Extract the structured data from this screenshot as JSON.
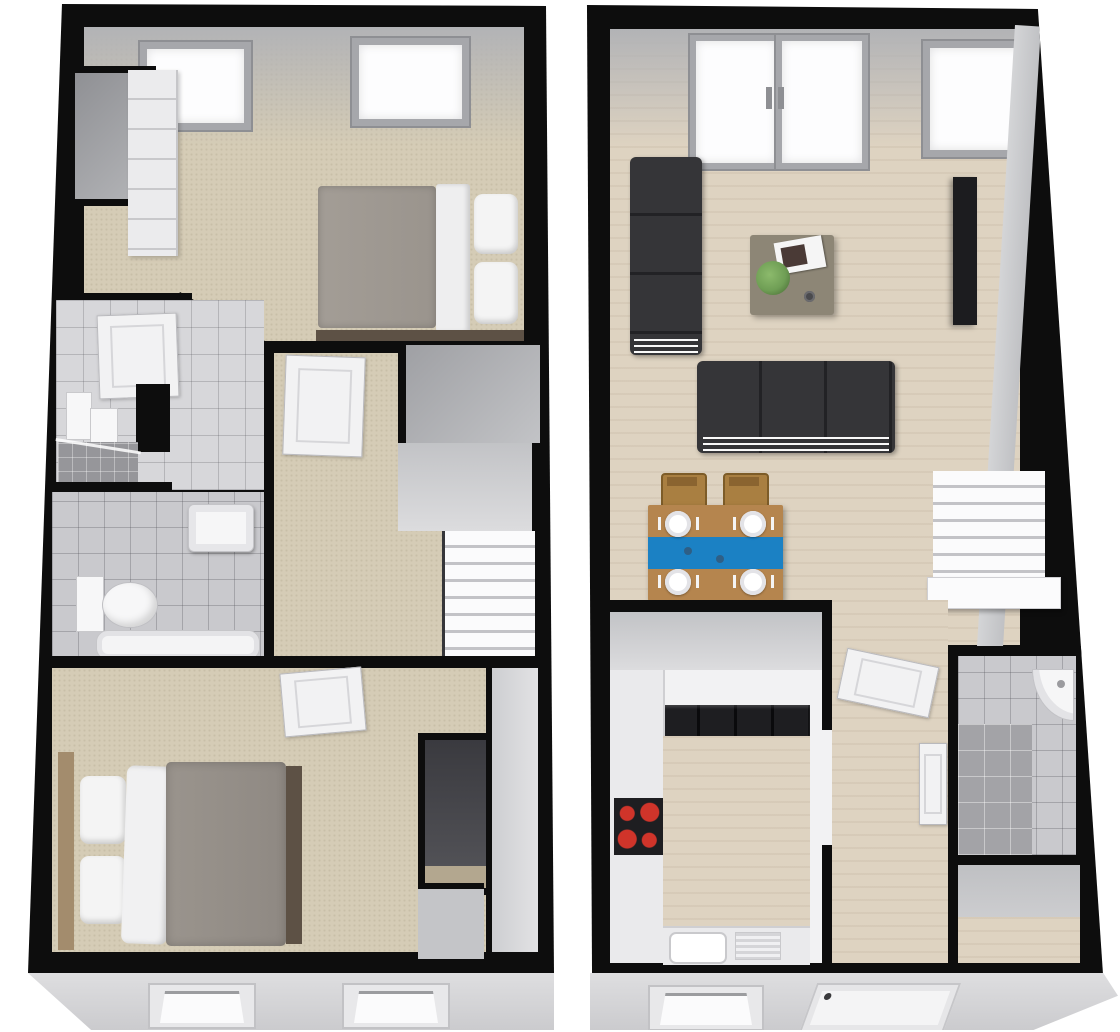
{
  "meta": {
    "type": "3d-dollhouse-floorplan",
    "floor_count": 2,
    "page_background": "#ffffff"
  },
  "colors": {
    "wall": "#0d0d0d",
    "carpet": "#d5ccb6",
    "wood": "#ded3c1",
    "tile_light": "#d7d7da",
    "tile_mid": "#c9c9cd",
    "tile_wet": "#a3a3a7",
    "wall_white": "#f2f2f3",
    "wall_grey": "#c7c8ca",
    "ceiling_grey": "#b2b3b6",
    "sofa_charcoal": "#353538",
    "duvet_grey": "#9a948d",
    "linen_white": "#f4f4f4",
    "bed_wood": "#a38c6d",
    "bed_base": "#5d5145",
    "table_wood": "#b5854e",
    "chair_wood": "#a97f41",
    "runner_blue": "#1b81c4",
    "coffee_table": "#8d8676",
    "plant_green": "#6f9e55",
    "hob_black": "#1e1e21",
    "hob_red": "#d0342a",
    "tv_black": "#1c1c1f",
    "exterior_grey": "#d9d9db",
    "glass_white": "#fdfdfe"
  },
  "first_floor": {
    "position": "left-panel",
    "rooms": [
      {
        "name": "bedroom-1",
        "floor_finish": "carpet",
        "furniture": [
          "double-bed-grey-duvet",
          "wardrobe-drawer-unit",
          "built-in-cupboard"
        ],
        "windows": [
          "roof-window",
          "roof-window"
        ]
      },
      {
        "name": "en-suite-shower-room",
        "floor_finish": "tile",
        "furniture": [
          "shower-enclosure-glass",
          "vanity-unit"
        ],
        "doors": [
          "door-from-bedroom-1"
        ]
      },
      {
        "name": "bathroom",
        "floor_finish": "tile",
        "furniture": [
          "wall-hung-basin",
          "toilet",
          "bath"
        ]
      },
      {
        "name": "landing",
        "floor_finish": "carpet",
        "furniture": [
          "staircase-down",
          "storage-cupboard"
        ],
        "doors": [
          "door-to-bedroom-1"
        ],
        "stair_treads": 7
      },
      {
        "name": "bedroom-2",
        "floor_finish": "carpet",
        "furniture": [
          "double-bed-grey-duvet",
          "built-in-wardrobe-dark"
        ],
        "doors": [
          "door-from-landing"
        ]
      }
    ],
    "exterior": {
      "front_windows": 2
    }
  },
  "ground_floor": {
    "position": "right-panel",
    "rooms": [
      {
        "name": "living-room",
        "floor_finish": "wood",
        "furniture": [
          "sofa-3-seat-charcoal",
          "sofa-3-seat-charcoal",
          "coffee-table",
          "wall-tv"
        ],
        "coffee_table_items": [
          "magazines",
          "plant",
          "cup"
        ],
        "windows": [
          "french-doors",
          "window"
        ]
      },
      {
        "name": "dining-area",
        "floor_finish": "wood",
        "furniture": [
          "dining-table-blue-runner",
          "chair",
          "chair"
        ],
        "place_settings": 4
      },
      {
        "name": "staircase",
        "stair_treads": 8
      },
      {
        "name": "kitchen",
        "floor_finish": "wood",
        "furniture": [
          "worktop-left",
          "worktop-bottom",
          "appliance-run-dark",
          "hob-4-ring",
          "sink-with-drainer"
        ]
      },
      {
        "name": "hallway",
        "floor_finish": "wood",
        "doors": [
          "door",
          "door",
          "front-door"
        ]
      },
      {
        "name": "shower-room",
        "floor_finish": "tile",
        "furniture": [
          "corner-basin",
          "shower-area"
        ]
      },
      {
        "name": "store-cupboard",
        "floor_finish": "wood"
      }
    ],
    "exterior": {
      "front_windows": 1,
      "front_doors": 1
    }
  }
}
